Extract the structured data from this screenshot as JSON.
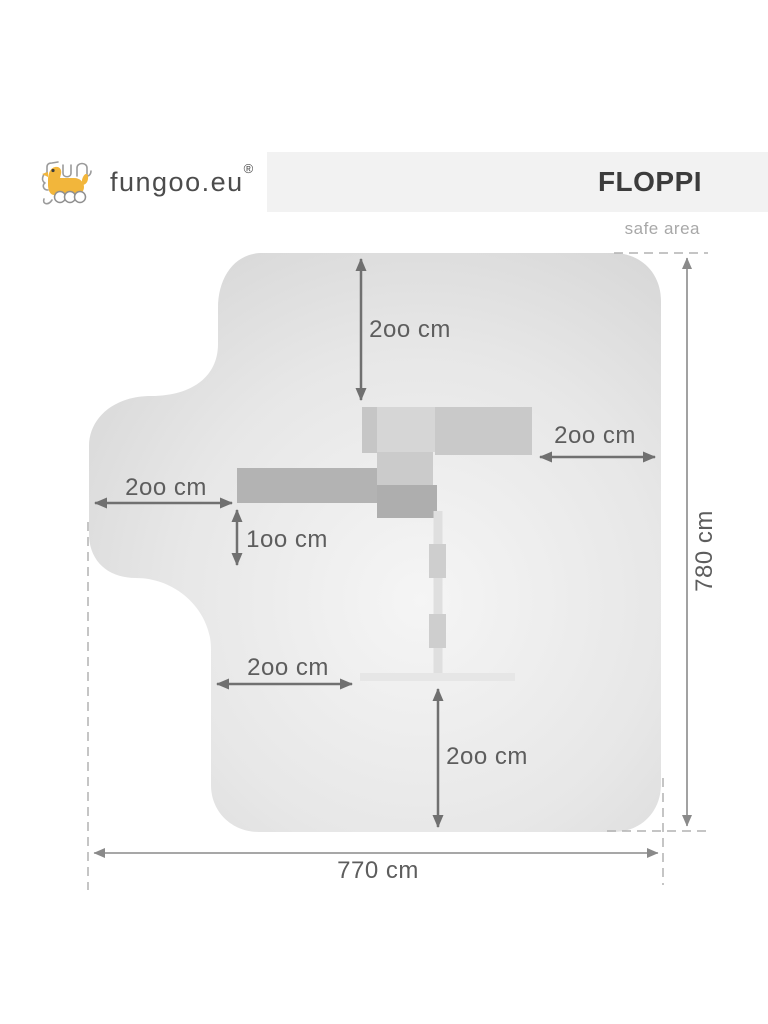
{
  "brand": {
    "name": "fungoo.eu",
    "registered_mark": "®",
    "logo_icon": "fungoo-dog-icon",
    "logo_yellow": "#f2b63b"
  },
  "header": {
    "title": "FLOPPI",
    "subtitle": "safe area"
  },
  "diagram": {
    "description": "top view safe-area plan of FLOPPI playset",
    "labels": {
      "top_clearance": "2oo cm",
      "right_clearance": "2oo cm",
      "left_clearance": "2oo cm",
      "deck_clearance": "1oo cm",
      "swing_side_clearance": "2oo cm",
      "swing_front_clearance": "2oo cm",
      "overall_depth": "780 cm",
      "overall_width": "770 cm"
    },
    "colors": {
      "safe_area_edge": "#d4d4d4",
      "safe_area_center": "#f5f5f5",
      "structure_dark": "#aeaeae",
      "structure_mid": "#c9c9c9",
      "structure_light": "#d6d6d6",
      "arrow": "#707070",
      "dimension_line": "#8a8a8a",
      "dashed_line": "#b2b2b2",
      "label_text": "#5d5d5d",
      "title_band": "#f2f2f2"
    }
  }
}
